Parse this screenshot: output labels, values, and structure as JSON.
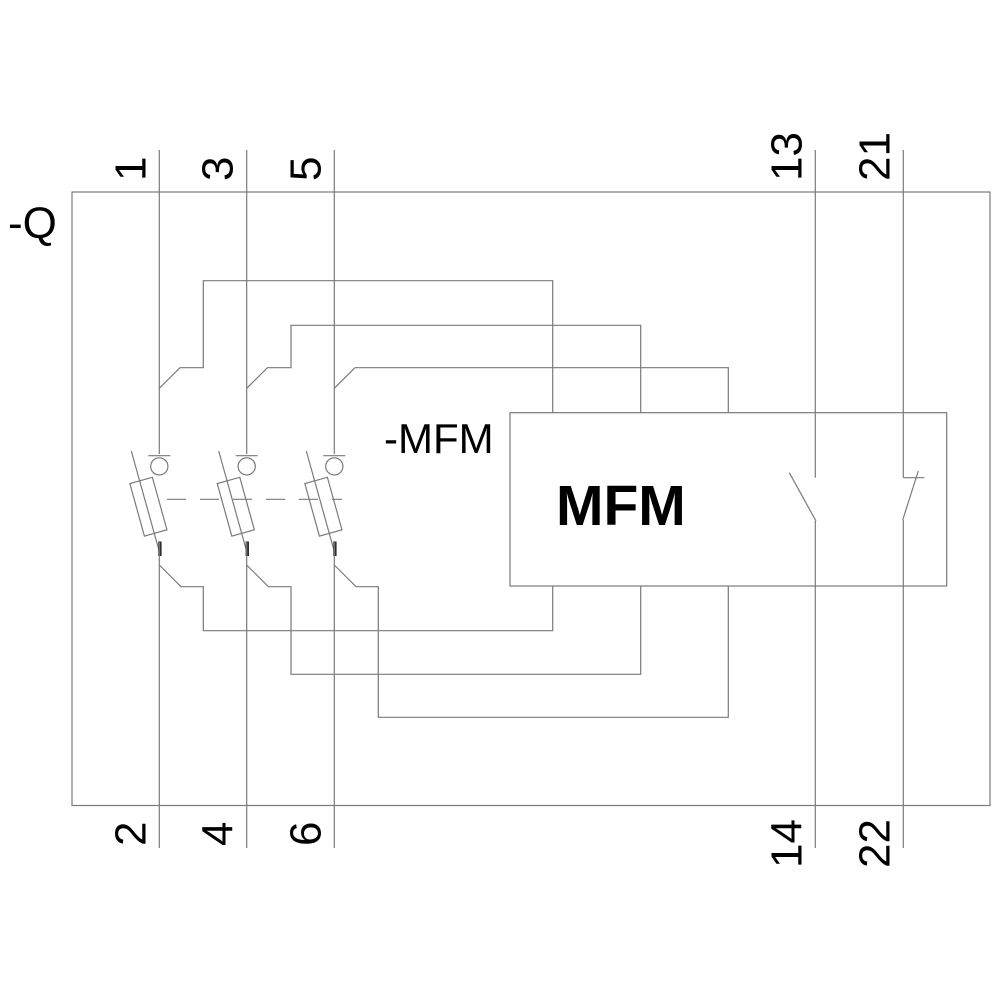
{
  "diagram": {
    "device_ref_label": "-Q",
    "mfm_ref_label": "-MFM",
    "mfm_box_label": "MFM",
    "terminals_top": [
      "1",
      "3",
      "5",
      "13",
      "21"
    ],
    "terminals_bottom": [
      "2",
      "4",
      "6",
      "14",
      "22"
    ],
    "colors": {
      "line": "#7a7a7a",
      "text": "#000000",
      "background": "#ffffff"
    }
  }
}
